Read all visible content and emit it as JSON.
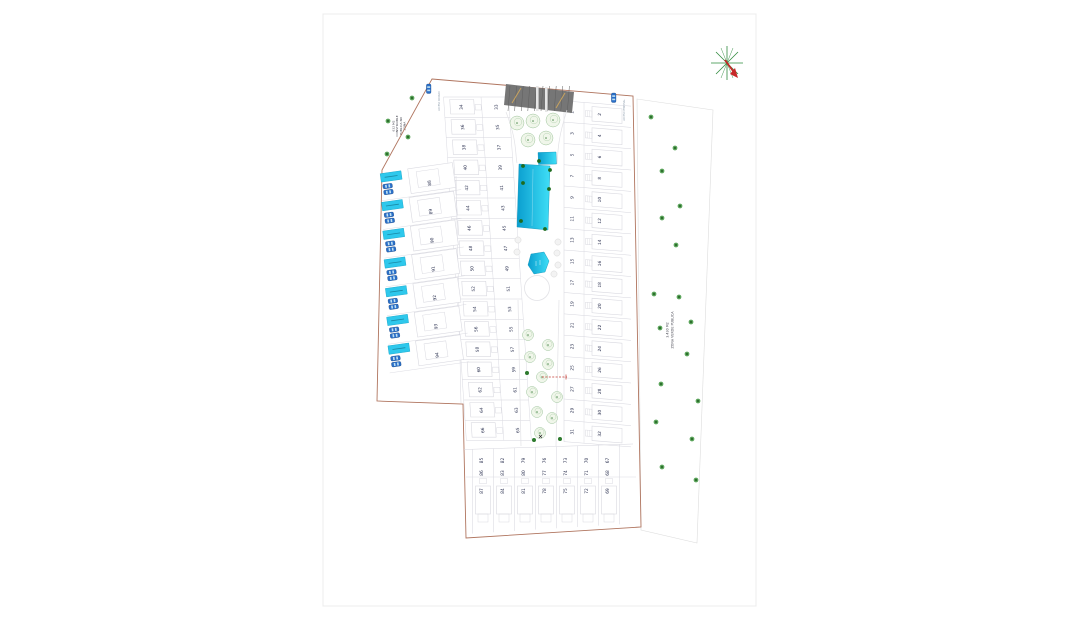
{
  "document": {
    "type": "residential-site-plan",
    "sheet_background": "#ffffff"
  },
  "labels": {
    "zona_publica_lines": [
      "ZONA",
      "PUBLICA NO",
      "CONSTRUIBLE",
      "632 M2"
    ],
    "zona_verde_lines": [
      "ZONA VERDE PUBLICA",
      "3.430 M2"
    ],
    "access_labels": [
      "ACCESO RODADO",
      "ACCESO PEATONAL"
    ]
  },
  "blocks": {
    "right_inner": [
      "1",
      "3",
      "5",
      "7",
      "9",
      "11",
      "13",
      "15",
      "17",
      "19",
      "21",
      "23",
      "25",
      "27",
      "29",
      "31"
    ],
    "right_outer": [
      "2",
      "4",
      "6",
      "8",
      "10",
      "12",
      "14",
      "16",
      "18",
      "20",
      "22",
      "24",
      "26",
      "28",
      "30",
      "32"
    ],
    "center_inner": [
      "33",
      "35",
      "37",
      "39",
      "41",
      "43",
      "45",
      "47",
      "49",
      "51",
      "53",
      "55",
      "57",
      "59",
      "61",
      "63",
      "65"
    ],
    "center_outer": [
      "34",
      "36",
      "38",
      "40",
      "42",
      "44",
      "46",
      "48",
      "50",
      "52",
      "54",
      "56",
      "58",
      "60",
      "62",
      "64",
      "66"
    ],
    "left": [
      "88",
      "89",
      "90",
      "91",
      "92",
      "93",
      "94"
    ],
    "bottom_columns": [
      [
        "85",
        "86",
        "87"
      ],
      [
        "82",
        "83",
        "84"
      ],
      [
        "79",
        "80",
        "81"
      ],
      [
        "76",
        "77",
        "78"
      ],
      [
        "73",
        "74",
        "75"
      ],
      [
        "70",
        "71",
        "72"
      ],
      [
        "67",
        "68",
        "69"
      ]
    ]
  },
  "colors": {
    "boundary": "#b0755f",
    "lot_line": "#d6d6de",
    "footprint": "#d9d9e0",
    "number": "#2b3150",
    "pool_dark": "#0a9ecf",
    "pool_light": "#3fdef6",
    "private_pool": "#2ec8ec",
    "car": "#2a6fc9",
    "canopy": "#767676",
    "tree_green": "#4a934a",
    "bush_green": "#1e6b1e",
    "sheet_border": "#ececec",
    "label_text": "#4a4a55",
    "red_annotation": "#c33b33"
  },
  "trees": {
    "green_zone": [
      [
        651,
        117
      ],
      [
        675,
        148
      ],
      [
        662,
        171
      ],
      [
        680,
        206
      ],
      [
        662,
        218
      ],
      [
        676,
        245
      ],
      [
        654,
        294
      ],
      [
        679,
        297
      ],
      [
        691,
        322
      ],
      [
        660,
        328
      ],
      [
        687,
        354
      ],
      [
        661,
        384
      ],
      [
        698,
        401
      ],
      [
        656,
        422
      ],
      [
        692,
        439
      ],
      [
        662,
        467
      ],
      [
        696,
        480
      ]
    ],
    "public_zone": [
      [
        412,
        98
      ],
      [
        388,
        121
      ],
      [
        408,
        137
      ],
      [
        387,
        154
      ]
    ],
    "garden_upper": [
      [
        517,
        123
      ],
      [
        533,
        121
      ],
      [
        553,
        120
      ],
      [
        528,
        140
      ],
      [
        546,
        138
      ]
    ],
    "garden_lower": [
      [
        528,
        335
      ],
      [
        548,
        345
      ],
      [
        530,
        357
      ],
      [
        548,
        364
      ],
      [
        542,
        377
      ],
      [
        532,
        392
      ],
      [
        557,
        397
      ],
      [
        537,
        412
      ],
      [
        552,
        418
      ],
      [
        540,
        433
      ]
    ],
    "garden_dots": [
      [
        527,
        373
      ],
      [
        534,
        440
      ],
      [
        560,
        439
      ]
    ],
    "pool_bushes": [
      [
        523,
        166
      ],
      [
        539,
        161
      ],
      [
        550,
        170
      ],
      [
        523,
        183
      ],
      [
        549,
        189
      ],
      [
        521,
        221
      ],
      [
        545,
        229
      ]
    ],
    "stones": [
      [
        518,
        240
      ],
      [
        517,
        252
      ],
      [
        558,
        242
      ],
      [
        557,
        253
      ],
      [
        558,
        265
      ],
      [
        554,
        274
      ]
    ]
  },
  "compass": {
    "ray_color": "#2e8b3d",
    "arrow_color": "#c62828"
  }
}
